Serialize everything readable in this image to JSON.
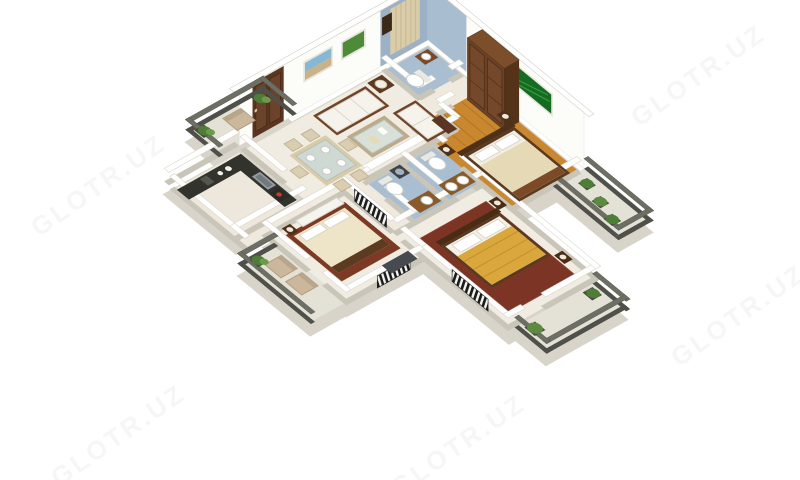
{
  "watermark": {
    "text": "GLOTR.UZ",
    "color": "#6b6b80",
    "opacity": "0.05"
  },
  "scene": {
    "type": "3d-isometric-floor-plan",
    "description": "3-bedroom apartment 3D floor plan render, white background",
    "palette": {
      "wall_top": "#ffffff",
      "wall_side": "#c9c5b9",
      "floor_cream": "#f1ece2",
      "floor_wood": "#c9882f",
      "floor_bath_blue": "#a9bed0",
      "carpet_maroon": "#7c3524",
      "balcony_floor": "#e4e1d6",
      "parapet": "#6e6f64",
      "dark_wood": "#6b4226",
      "counter_black": "#33332e",
      "blanket_gold": "#d9a73c",
      "blanket_cream": "#e6dab6",
      "plant_green": "#4e7d38",
      "blind_stripes": "#1b1b1b"
    },
    "rooms": [
      {
        "name": "living-room",
        "floor": "#f1ece2",
        "furniture": [
          "sofa-3seat",
          "sofa-2seat",
          "corner-table-lamp",
          "glass-coffee-table",
          "tv-cabinet",
          "wall-picture-beach",
          "wall-picture-green",
          "entry-door"
        ]
      },
      {
        "name": "dining-area",
        "floor": "#f1ece2",
        "furniture": [
          "glass-dining-table",
          "six-chairs",
          "plates"
        ]
      },
      {
        "name": "bathroom-top",
        "floor": "#a9bed0",
        "furniture": [
          "toilet",
          "vanity-sink",
          "curtain",
          "wall-niche"
        ]
      },
      {
        "name": "bedroom-1-top-right",
        "floor": "#c9882f",
        "furniture": [
          "wardrobe-dark-wood",
          "double-bed-cream",
          "nightstands-lamps",
          "green-wall-art"
        ]
      },
      {
        "name": "bedroom-2-right",
        "floor": "#7c3524",
        "furniture": [
          "double-bed-gold",
          "nightstands-lamps",
          "window-blind"
        ]
      },
      {
        "name": "bathroom-center-a",
        "floor": "#a9bed0",
        "furniture": [
          "toilet",
          "double-vanity"
        ]
      },
      {
        "name": "bathroom-center-b",
        "floor": "#a9bed0",
        "furniture": [
          "toilet",
          "vanity",
          "washing-machine"
        ]
      },
      {
        "name": "kitchen",
        "floor": "#eee8dc",
        "furniture": [
          "l-counter-black",
          "sink",
          "stove-red-knob",
          "dishes"
        ]
      },
      {
        "name": "bedroom-3-bottom",
        "floor": "#f1ece2",
        "furniture": [
          "double-bed-maroon-cream",
          "white-dresser",
          "nightstand",
          "tv-unit",
          "window-blind"
        ]
      },
      {
        "name": "balcony-left",
        "floor": "#e4e1d6",
        "furniture": [
          "wicker-chair",
          "potted-plants"
        ]
      },
      {
        "name": "balcony-right-top",
        "floor": "#e4e1d6",
        "furniture": [
          "potted-plants"
        ]
      },
      {
        "name": "balcony-right-bottom",
        "floor": "#e4e1d6",
        "furniture": [
          "potted-plants"
        ]
      },
      {
        "name": "balcony-bottom",
        "floor": "#e4e1d6",
        "furniture": [
          "armchair",
          "armchair",
          "potted-plant"
        ]
      }
    ]
  }
}
